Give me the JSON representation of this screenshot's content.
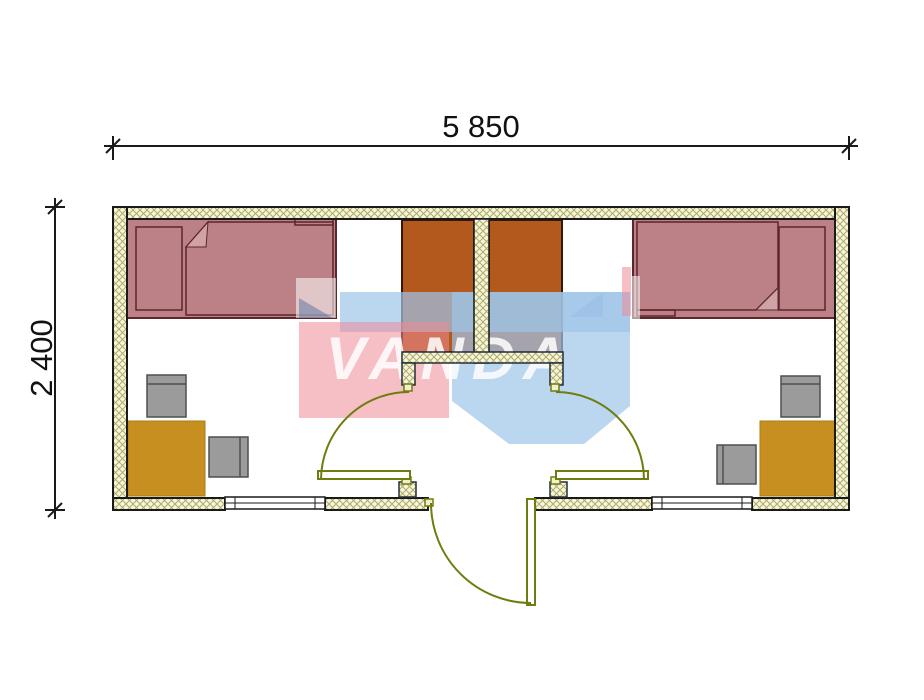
{
  "dimensions": {
    "width_label": "5 850",
    "height_label": "2 400"
  },
  "watermark": {
    "text": "VANDA"
  },
  "colors": {
    "outline": "#1a1a1a",
    "vestibule_outline": "#242e3a",
    "wall_hatch_bg": "#f7f5da",
    "wall_hatch_line": "#adac6d",
    "bed": "#bc8186",
    "bed_outline": "#5d262c",
    "bed_fold": "#cfa3a6",
    "wardrobe": "#b4591e",
    "wardrobe_outline": "#33180a",
    "desk": "#c78f1f",
    "chair": "#9b9b9b",
    "door": "#6f7c10",
    "door_hinge_fill": "#f2efcc",
    "watermark_blue": "#9ec4e8",
    "watermark_pink": "#ef8b96",
    "watermark_slate": "#5a6ea0"
  }
}
